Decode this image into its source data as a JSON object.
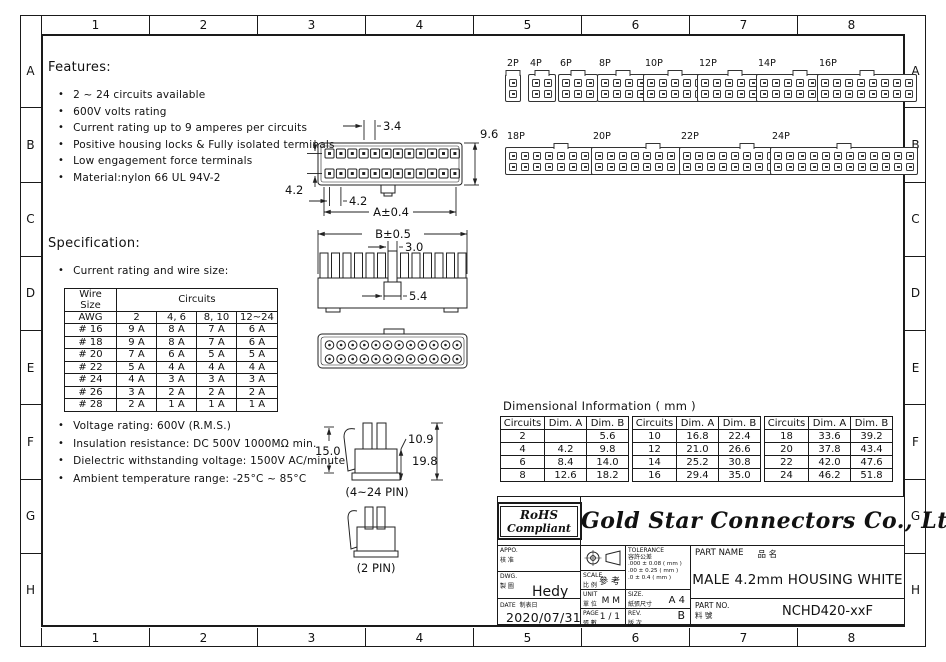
{
  "border": {
    "top_labels": [
      "1",
      "2",
      "3",
      "4",
      "5",
      "6",
      "7",
      "8"
    ],
    "bottom_labels": [
      "1",
      "2",
      "3",
      "4",
      "5",
      "6",
      "7",
      "8"
    ],
    "left_labels": [
      "A",
      "B",
      "C",
      "D",
      "E",
      "F",
      "G",
      "H"
    ],
    "right_labels": [
      "A",
      "B",
      "C",
      "D",
      "E",
      "F",
      "G",
      "H"
    ]
  },
  "features": {
    "title": "Features:",
    "items": [
      "2 ~ 24 circuits available",
      "600V volts rating",
      "Current rating up to 9 amperes per circuits",
      "Positive housing locks & Fully isolated terminals",
      "Low engagement force terminals",
      "Material:nylon 66 UL 94V-2"
    ]
  },
  "specification": {
    "title": "Specification:",
    "subtitle": "Current rating and wire size:",
    "table": {
      "col0_header": "Wire Size",
      "col0_sub": "AWG",
      "group_header": "Circuits",
      "subcols": [
        "2",
        "4, 6",
        "8, 10",
        "12~24"
      ],
      "rows": [
        [
          "# 16",
          "9 A",
          "8 A",
          "7 A",
          "6 A"
        ],
        [
          "# 18",
          "9 A",
          "8 A",
          "7 A",
          "6 A"
        ],
        [
          "# 20",
          "7 A",
          "6 A",
          "5 A",
          "5 A"
        ],
        [
          "# 22",
          "5 A",
          "4 A",
          "4 A",
          "4 A"
        ],
        [
          "# 24",
          "4 A",
          "3 A",
          "3 A",
          "3 A"
        ],
        [
          "# 26",
          "3 A",
          "2 A",
          "2 A",
          "2 A"
        ],
        [
          "# 28",
          "2 A",
          "1 A",
          "1 A",
          "1 A"
        ]
      ]
    },
    "notes": [
      "Voltage rating: 600V (R.M.S.)",
      "Insulation resistance: DC 500V 1000MΩ min.",
      "Dielectric withstanding voltage: 1500V AC/minute",
      "Ambient temperature range: -25°C ~ 85°C"
    ]
  },
  "drawings": {
    "front_view": {
      "pitch_top": "3.4",
      "height": "9.6",
      "row_pitch": "4.2",
      "pitch_bottom": "4.2",
      "overall_width": "A±0.4"
    },
    "comb_view": {
      "overall_width": "B±0.5",
      "post_width": "3.0",
      "latch_width": "5.4"
    },
    "profiles": {
      "multi_label": "(4~24 PIN)",
      "two_label": "(2 PIN)",
      "latch_height": "15.0",
      "body_height": "10.9",
      "total_height": "19.8"
    }
  },
  "gallery": {
    "row1": [
      {
        "label": "2P",
        "cols": 1
      },
      {
        "label": "4P",
        "cols": 2
      },
      {
        "label": "6P",
        "cols": 3
      },
      {
        "label": "8P",
        "cols": 4
      },
      {
        "label": "10P",
        "cols": 5
      },
      {
        "label": "12P",
        "cols": 6
      },
      {
        "label": "14P",
        "cols": 7
      },
      {
        "label": "16P",
        "cols": 8
      }
    ],
    "row2": [
      {
        "label": "18P",
        "cols": 9
      },
      {
        "label": "20P",
        "cols": 10
      },
      {
        "label": "22P",
        "cols": 11
      },
      {
        "label": "24P",
        "cols": 12
      }
    ]
  },
  "dimensional_info": {
    "title": "Dimensional Information ( mm )",
    "columns": [
      "Circuits",
      "Dim. A",
      "Dim. B"
    ],
    "g1": [
      [
        "2",
        "",
        "5.6"
      ],
      [
        "4",
        "4.2",
        "9.8"
      ],
      [
        "6",
        "8.4",
        "14.0"
      ],
      [
        "8",
        "12.6",
        "18.2"
      ]
    ],
    "g2": [
      [
        "10",
        "16.8",
        "22.4"
      ],
      [
        "12",
        "21.0",
        "26.6"
      ],
      [
        "14",
        "25.2",
        "30.8"
      ],
      [
        "16",
        "29.4",
        "35.0"
      ]
    ],
    "g3": [
      [
        "18",
        "33.6",
        "39.2"
      ],
      [
        "20",
        "37.8",
        "43.4"
      ],
      [
        "22",
        "42.0",
        "47.6"
      ],
      [
        "24",
        "46.2",
        "51.8"
      ]
    ]
  },
  "title_block": {
    "rohs": {
      "line1": "RoHS",
      "line2": "Compliant"
    },
    "company": "Gold Star Connectors Co., Ltd.",
    "appo": {
      "label": "APPO.",
      "label_cn": "核 准",
      "value": ""
    },
    "dwg": {
      "label": "DWG.",
      "label_cn": "製 圖",
      "value": "Hedy"
    },
    "date": {
      "label": "DATE",
      "label_cn": "制表日",
      "value": "2020/07/31"
    },
    "scale": {
      "label": "SCALE",
      "label_cn": "比 例",
      "value": "參 考"
    },
    "unit": {
      "label": "UNIT",
      "label_cn": "單 位",
      "value": "M M"
    },
    "page": {
      "label": "PAGE",
      "label_cn": "張 數",
      "value": "1 / 1"
    },
    "tolerance": {
      "label": "TOLERANCE",
      "label_cn": "容許公差",
      "lines": [
        ".000 ± 0.08 ( mm )",
        ".00 ± 0.25 ( mm )",
        ".0  ± 0.4  ( mm )"
      ]
    },
    "size": {
      "label": "SIZE.",
      "label_cn": "紙張尺寸",
      "value": "A 4"
    },
    "rev": {
      "label": "REV.",
      "label_cn": "版 次",
      "value": "B"
    },
    "part_name": {
      "label": "PART NAME",
      "label_cn": "品  名",
      "value": "MALE 4.2mm HOUSING WHITE"
    },
    "part_no": {
      "label": "PART NO.",
      "label_cn": "料  號",
      "value": "NCHD420-xxF"
    }
  }
}
